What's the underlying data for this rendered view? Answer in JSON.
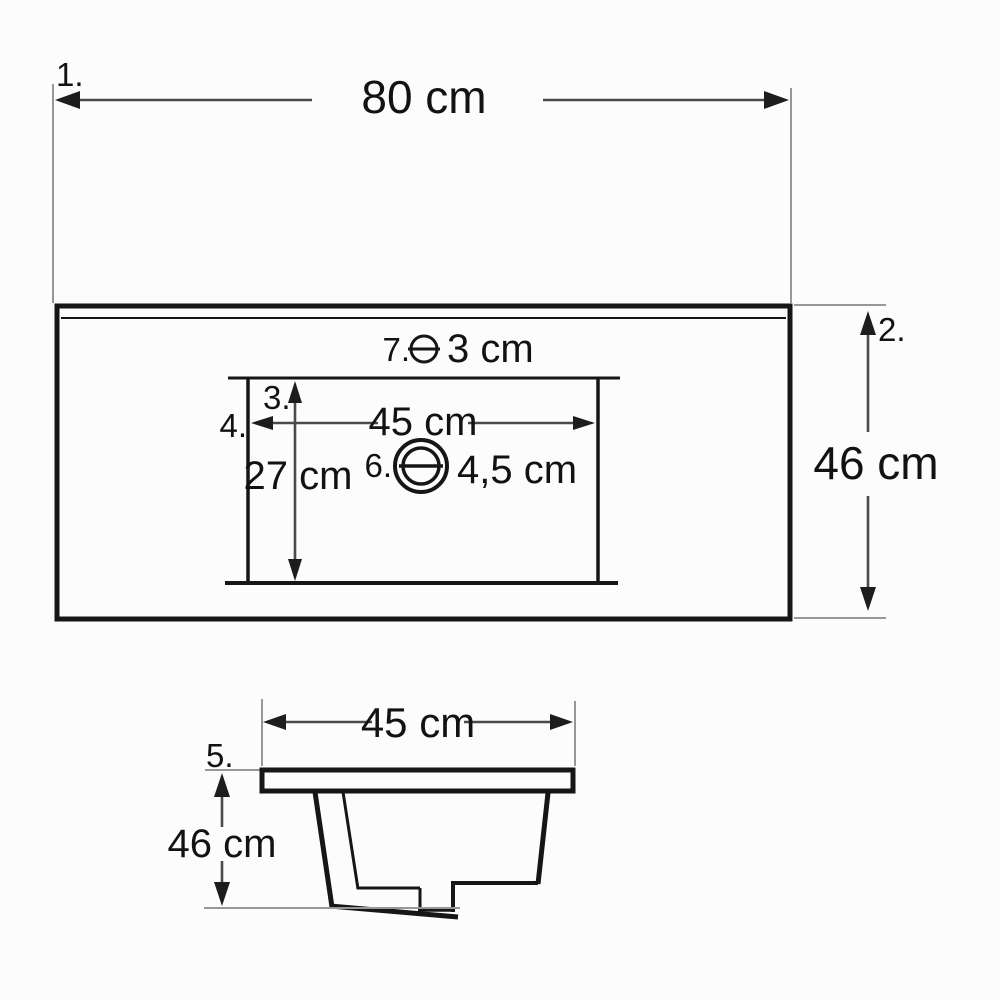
{
  "drawing": {
    "subject": "washbasin-technical-drawing",
    "colors": {
      "background": "#fcfcfc",
      "object_line": "#161616",
      "dimension_line": "#4a4a4a",
      "extension_line": "#979797",
      "text": "#121212"
    },
    "top_view": {
      "overall_width": {
        "label": "1.",
        "value": "80 cm"
      },
      "overall_depth": {
        "label": "2.",
        "value": "46 cm"
      },
      "basin_depth": {
        "label": "3.",
        "value": "27 cm"
      },
      "basin_width": {
        "label": "4.",
        "value": "45 cm"
      },
      "drain_hole": {
        "label": "6.",
        "value": "4,5 cm"
      },
      "faucet_hole": {
        "label": "7.",
        "value": "3 cm"
      }
    },
    "section_view": {
      "basin_top_width": {
        "label": "5.",
        "value": "45 cm"
      },
      "basin_height": {
        "value": "46 cm"
      }
    }
  }
}
